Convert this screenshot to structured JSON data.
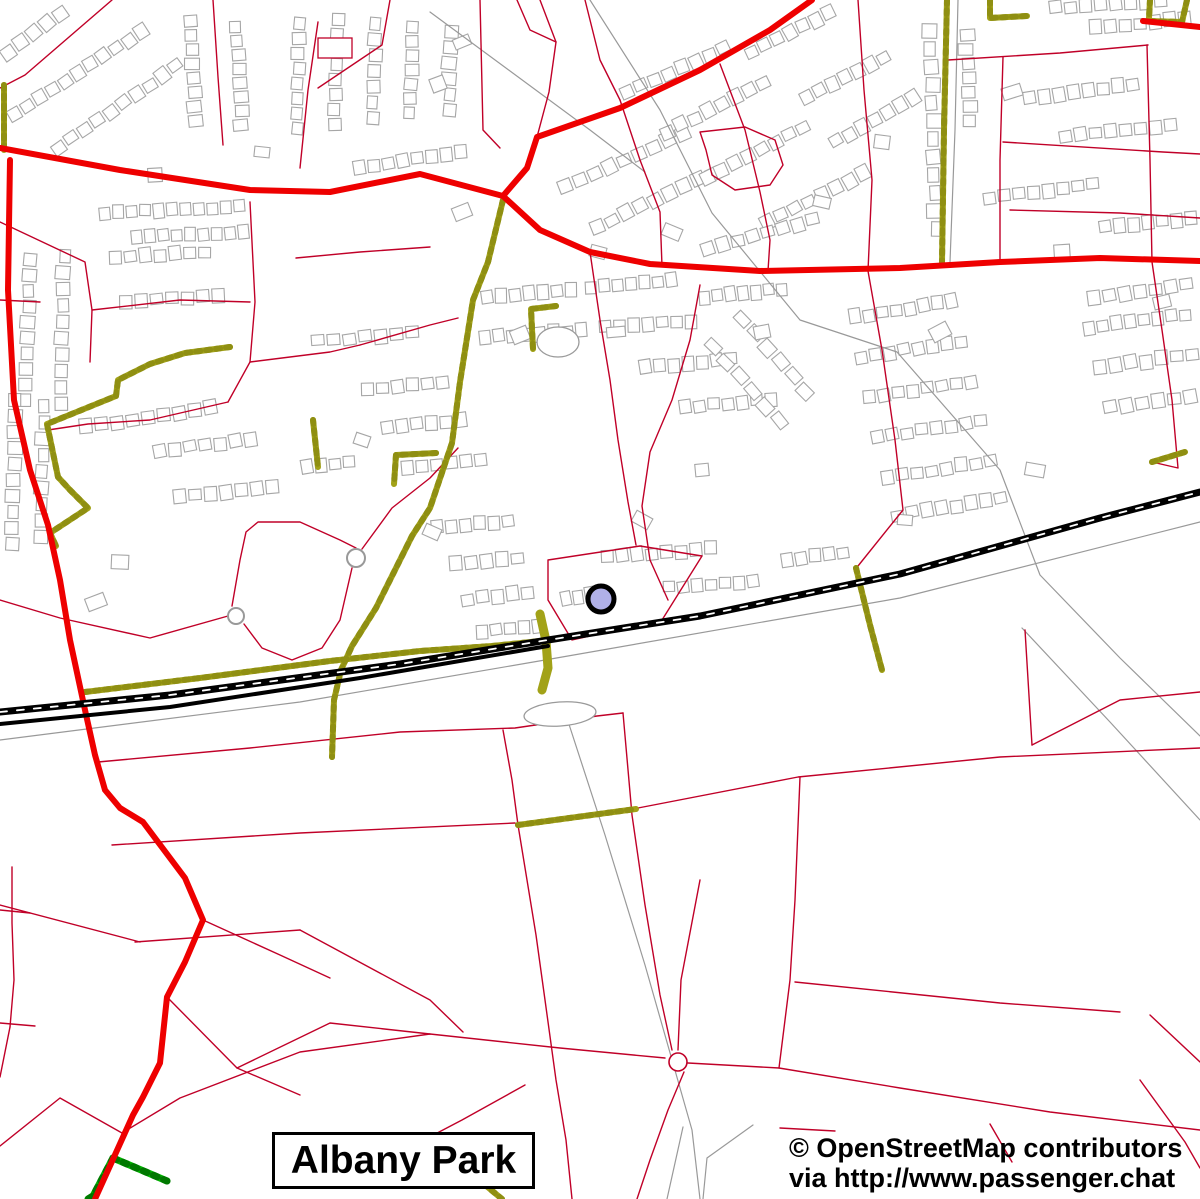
{
  "map": {
    "place_label": "Albany Park",
    "attribution_line1": "© OpenStreetMap contributors",
    "attribution_line2": "via http://www.passenger.chat",
    "marker": {
      "x": 601,
      "y": 599,
      "radius": 13
    }
  },
  "colors": {
    "background": "#ffffff",
    "major_road": "#ee0000",
    "minor_road": "#c00028",
    "track_road": "#a2a218",
    "track_road_hatch": "#8f8f12",
    "green_road": "#00b400",
    "green_road_hatch": "#007800",
    "railway": "#000000",
    "railway_tie": "#ffffff",
    "building_outline": "#a6a6a6",
    "footpath": "#999999",
    "water_outline": "#9a9a9a",
    "marker_fill": "#b0b0e8",
    "marker_outline": "#000000",
    "text": "#000000",
    "label_border": "#000000",
    "label_background": "#ffffff"
  }
}
